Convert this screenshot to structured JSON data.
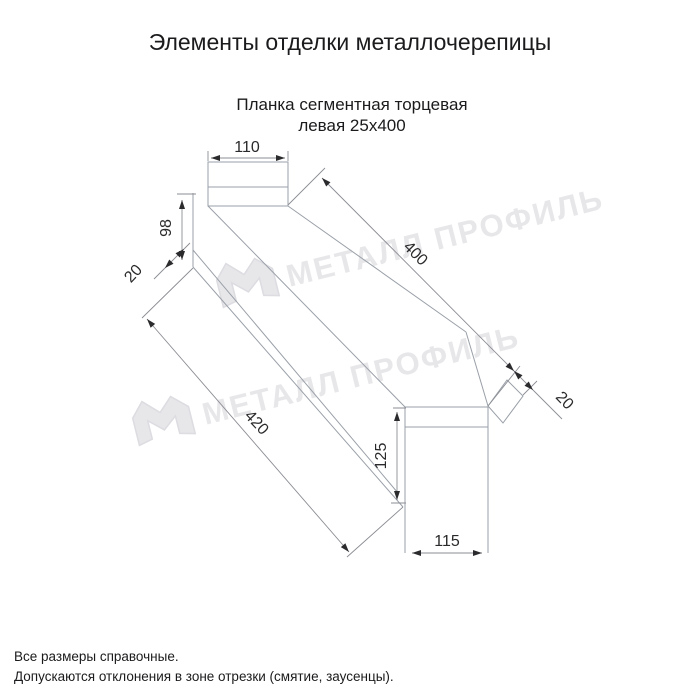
{
  "title": "Элементы отделки металлочерепицы",
  "subtitle": {
    "line1": "Планка сегментная торцевая",
    "line2": "левая 25х400"
  },
  "dimensions": {
    "flap_width_top": "110",
    "end_height": "98",
    "hem_left": "20",
    "length_top": "400",
    "hem_right": "20",
    "length_bottom": "420",
    "flap_height_right": "125",
    "flap_width_bottom": "115"
  },
  "watermark": {
    "text": "МЕТАЛЛ ПРОФИЛЬ"
  },
  "notes": {
    "line1": "Все размеры справочные.",
    "line2": "Допускаются отклонения в зоне отрезки (смятие, заусенцы)."
  },
  "colors": {
    "ink": "#1b1b1d",
    "geo": "#9aa0a8",
    "dim": "#8b8d94",
    "arrow": "#2b2b2e",
    "dimtext": "#2a2a2c",
    "wm": "#e7e7ea",
    "wmedge": "#dcdce1",
    "bg": "#ffffff"
  }
}
